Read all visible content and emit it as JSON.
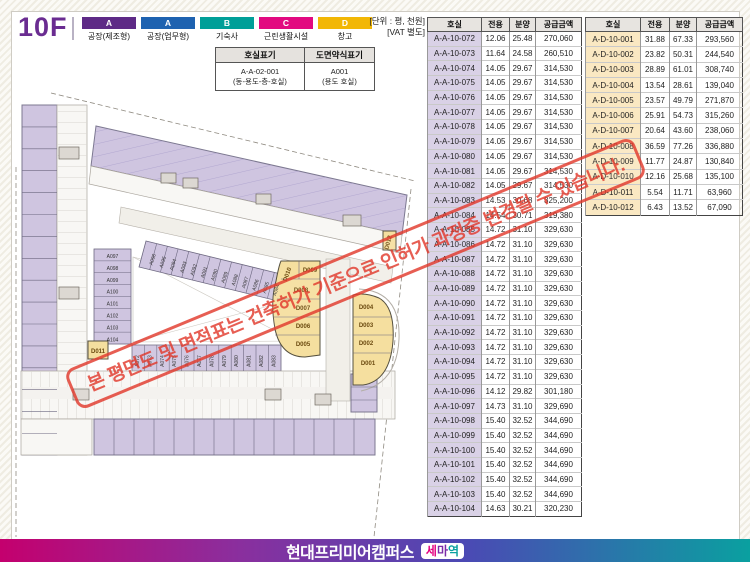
{
  "page": {
    "floor": "10F",
    "unit_note_line1": "[단위 : 평, 천원]",
    "unit_note_line2": "[VAT 별도]"
  },
  "legend": {
    "items": [
      {
        "code": "A",
        "label": "공장(제조형)",
        "color": "#5e2a86"
      },
      {
        "code": "A",
        "label": "공장(업무형)",
        "color": "#1e62b0"
      },
      {
        "code": "B",
        "label": "기숙사",
        "color": "#009f98"
      },
      {
        "code": "C",
        "label": "근린생활시설",
        "color": "#e20980"
      },
      {
        "code": "D",
        "label": "창고",
        "color": "#f2b705"
      }
    ]
  },
  "notation_table": {
    "headers": [
      "호실표기",
      "도면약식표기"
    ],
    "row_line1": [
      "A-A-02-001",
      "A001"
    ],
    "row_line2": [
      "(동-용도-층-호실)",
      "(용도 호실)"
    ]
  },
  "room_tables": [
    {
      "id": "a",
      "headers": [
        "호실",
        "전용",
        "분양",
        "공급금액"
      ],
      "room_bg": "#d9d1e6",
      "rows": [
        [
          "A-A-10-072",
          "12.06",
          "25.48",
          "270,060"
        ],
        [
          "A-A-10-073",
          "11.64",
          "24.58",
          "260,510"
        ],
        [
          "A-A-10-074",
          "14.05",
          "29.67",
          "314,530"
        ],
        [
          "A-A-10-075",
          "14.05",
          "29.67",
          "314,530"
        ],
        [
          "A-A-10-076",
          "14.05",
          "29.67",
          "314,530"
        ],
        [
          "A-A-10-077",
          "14.05",
          "29.67",
          "314,530"
        ],
        [
          "A-A-10-078",
          "14.05",
          "29.67",
          "314,530"
        ],
        [
          "A-A-10-079",
          "14.05",
          "29.67",
          "314,530"
        ],
        [
          "A-A-10-080",
          "14.05",
          "29.67",
          "314,530"
        ],
        [
          "A-A-10-081",
          "14.05",
          "29.67",
          "314,530"
        ],
        [
          "A-A-10-082",
          "14.05",
          "29.67",
          "314,530"
        ],
        [
          "A-A-10-083",
          "14.53",
          "30.68",
          "325,200"
        ],
        [
          "A-A-10-084",
          "14.54",
          "30.71",
          "319,380"
        ],
        [
          "A-A-10-085",
          "14.72",
          "31.10",
          "329,630"
        ],
        [
          "A-A-10-086",
          "14.72",
          "31.10",
          "329,630"
        ],
        [
          "A-A-10-087",
          "14.72",
          "31.10",
          "329,630"
        ],
        [
          "A-A-10-088",
          "14.72",
          "31.10",
          "329,630"
        ],
        [
          "A-A-10-089",
          "14.72",
          "31.10",
          "329,630"
        ],
        [
          "A-A-10-090",
          "14.72",
          "31.10",
          "329,630"
        ],
        [
          "A-A-10-091",
          "14.72",
          "31.10",
          "329,630"
        ],
        [
          "A-A-10-092",
          "14.72",
          "31.10",
          "329,630"
        ],
        [
          "A-A-10-093",
          "14.72",
          "31.10",
          "329,630"
        ],
        [
          "A-A-10-094",
          "14.72",
          "31.10",
          "329,630"
        ],
        [
          "A-A-10-095",
          "14.72",
          "31.10",
          "329,630"
        ],
        [
          "A-A-10-096",
          "14.12",
          "29.82",
          "301,180"
        ],
        [
          "A-A-10-097",
          "14.73",
          "31.10",
          "329,690"
        ],
        [
          "A-A-10-098",
          "15.40",
          "32.52",
          "344,690"
        ],
        [
          "A-A-10-099",
          "15.40",
          "32.52",
          "344,690"
        ],
        [
          "A-A-10-100",
          "15.40",
          "32.52",
          "344,690"
        ],
        [
          "A-A-10-101",
          "15.40",
          "32.52",
          "344,690"
        ],
        [
          "A-A-10-102",
          "15.40",
          "32.52",
          "344,690"
        ],
        [
          "A-A-10-103",
          "15.40",
          "32.52",
          "344,690"
        ],
        [
          "A-A-10-104",
          "14.63",
          "30.21",
          "320,230"
        ]
      ]
    },
    {
      "id": "d",
      "headers": [
        "호실",
        "전용",
        "분양",
        "공급금액"
      ],
      "room_bg": "#fae8c2",
      "rows": [
        [
          "A-D-10-001",
          "31.88",
          "67.33",
          "293,560"
        ],
        [
          "A-D-10-002",
          "23.82",
          "50.31",
          "244,540"
        ],
        [
          "A-D-10-003",
          "28.89",
          "61.01",
          "308,740"
        ],
        [
          "A-D-10-004",
          "13.54",
          "28.61",
          "139,040"
        ],
        [
          "A-D-10-005",
          "23.57",
          "49.79",
          "271,870"
        ],
        [
          "A-D-10-006",
          "25.91",
          "54.73",
          "315,260"
        ],
        [
          "A-D-10-007",
          "20.64",
          "43.60",
          "238,060"
        ],
        [
          "A-D-10-008",
          "36.59",
          "77.26",
          "336,880"
        ],
        [
          "A-D-10-009",
          "11.77",
          "24.87",
          "130,840"
        ],
        [
          "A-D-10-010",
          "12.16",
          "25.68",
          "135,100"
        ],
        [
          "A-D-10-011",
          "5.54",
          "11.71",
          "63,960"
        ],
        [
          "A-D-10-012",
          "6.43",
          "13.52",
          "67,090"
        ]
      ]
    }
  ],
  "plan": {
    "left_rooms": [
      "A097",
      "A098",
      "A099",
      "A100",
      "A101",
      "A102",
      "A103",
      "A104"
    ],
    "diagonal_rooms": [
      "A096",
      "A095",
      "A094",
      "A093",
      "A092",
      "A091",
      "A090",
      "A089",
      "A088",
      "A087",
      "A086",
      "A085",
      "A084"
    ],
    "bottom_rooms": [
      "A072",
      "A073",
      "A074",
      "A075",
      "A076",
      "A077",
      "A078",
      "A079",
      "A080",
      "A081",
      "A082",
      "A083"
    ],
    "d_left_rooms": [
      "D010",
      "D009",
      "D008",
      "D007",
      "D006",
      "D005"
    ],
    "d_right_rooms": [
      "D004",
      "D003",
      "D002",
      "D001"
    ],
    "other_rooms": [
      "D011",
      "D012"
    ]
  },
  "watermark": {
    "text": "본 평면도 및 면적표는 건축허가 기준으로 인허가 과정중 변경될 수 있습니다.",
    "color": "#e23b2e"
  },
  "footer": {
    "brand": "현대프리미어캠퍼스",
    "badge": "세마역"
  }
}
